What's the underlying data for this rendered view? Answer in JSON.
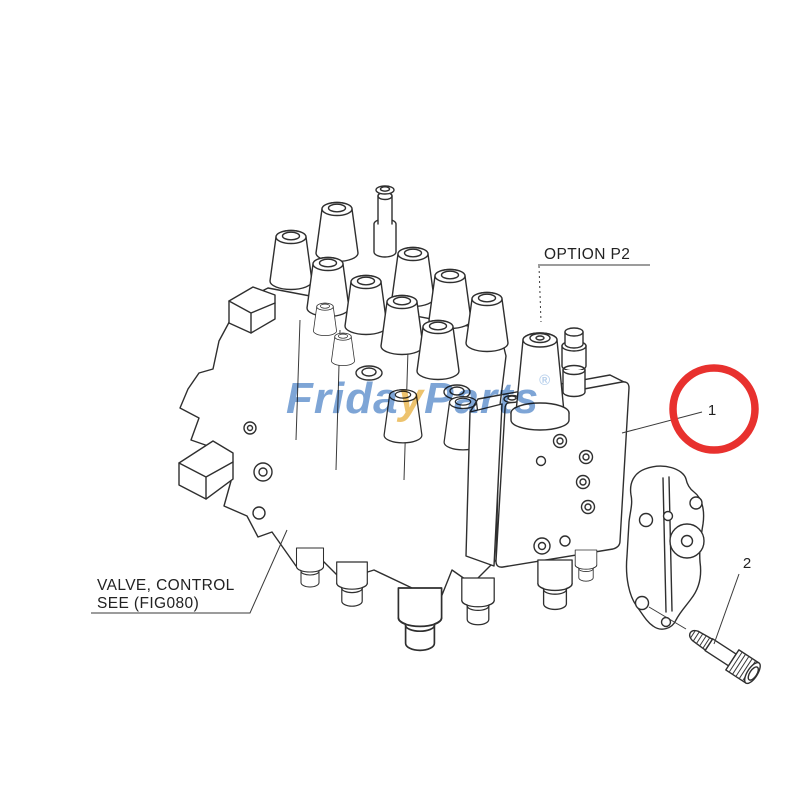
{
  "figure": {
    "description": "Exploded parts diagram of a hydraulic control valve assembly",
    "labels": {
      "option_p2": "OPTION P2",
      "valve_control_line1": "VALVE, CONTROL",
      "valve_control_line2": "SEE (FIG080)",
      "callout_1": "1",
      "callout_2": "2"
    },
    "colors": {
      "line": "#2f2f2f",
      "highlight_red": "#e8312e",
      "watermark_blue": "#5e8fcc",
      "watermark_yellow": "#e9b44a",
      "background": "#ffffff"
    }
  },
  "watermark": {
    "prefix": "Frida",
    "swoosh": "y",
    "suffix": "Parts",
    "registered": "®"
  }
}
